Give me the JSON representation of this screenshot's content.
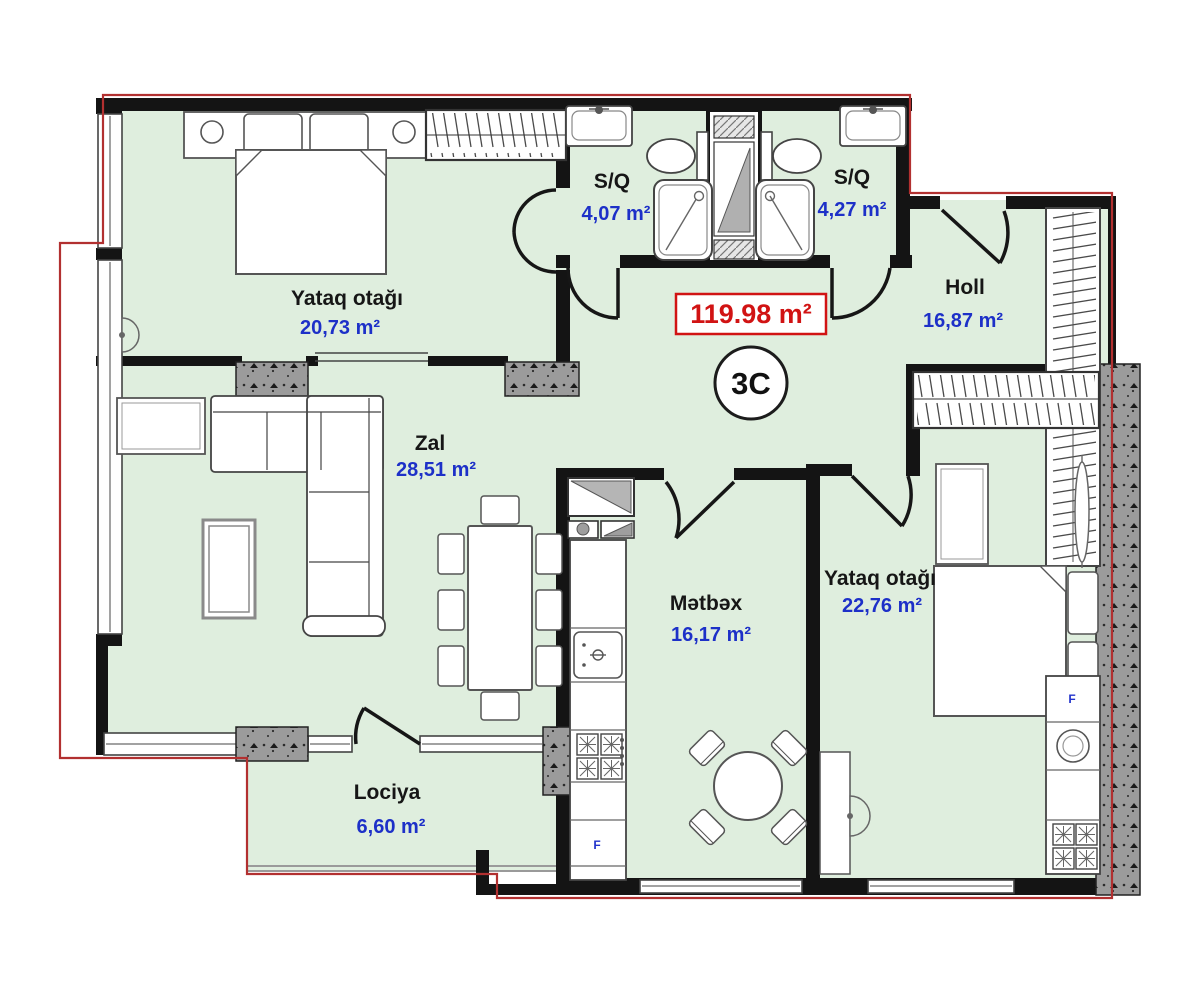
{
  "plan": {
    "total_area": "119.98 m²",
    "unit": "3C",
    "appliance_label": "F"
  },
  "rooms": {
    "bedroom1": {
      "name": "Yataq otağı",
      "area": "20,73 m²"
    },
    "sq1": {
      "name": "S/Q",
      "area": "4,07 m²"
    },
    "sq2": {
      "name": "S/Q",
      "area": "4,27 m²"
    },
    "holl": {
      "name": "Holl",
      "area": "16,87 m²"
    },
    "zal": {
      "name": "Zal",
      "area": "28,51 m²"
    },
    "kitchen": {
      "name": "Mətbəx",
      "area": "16,17 m²"
    },
    "bedroom2": {
      "name": "Yataq otağı",
      "area": "22,76 m²"
    },
    "loggia": {
      "name": "Lociya",
      "area": "6,60 m²"
    }
  },
  "colors": {
    "room_fill": "#dfeede",
    "wall_black": "#141414",
    "boundary_red": "#b23030",
    "area_red": "#d11313",
    "label_blue": "#1d30c8",
    "concrete_gray": "#9b9b9b"
  }
}
